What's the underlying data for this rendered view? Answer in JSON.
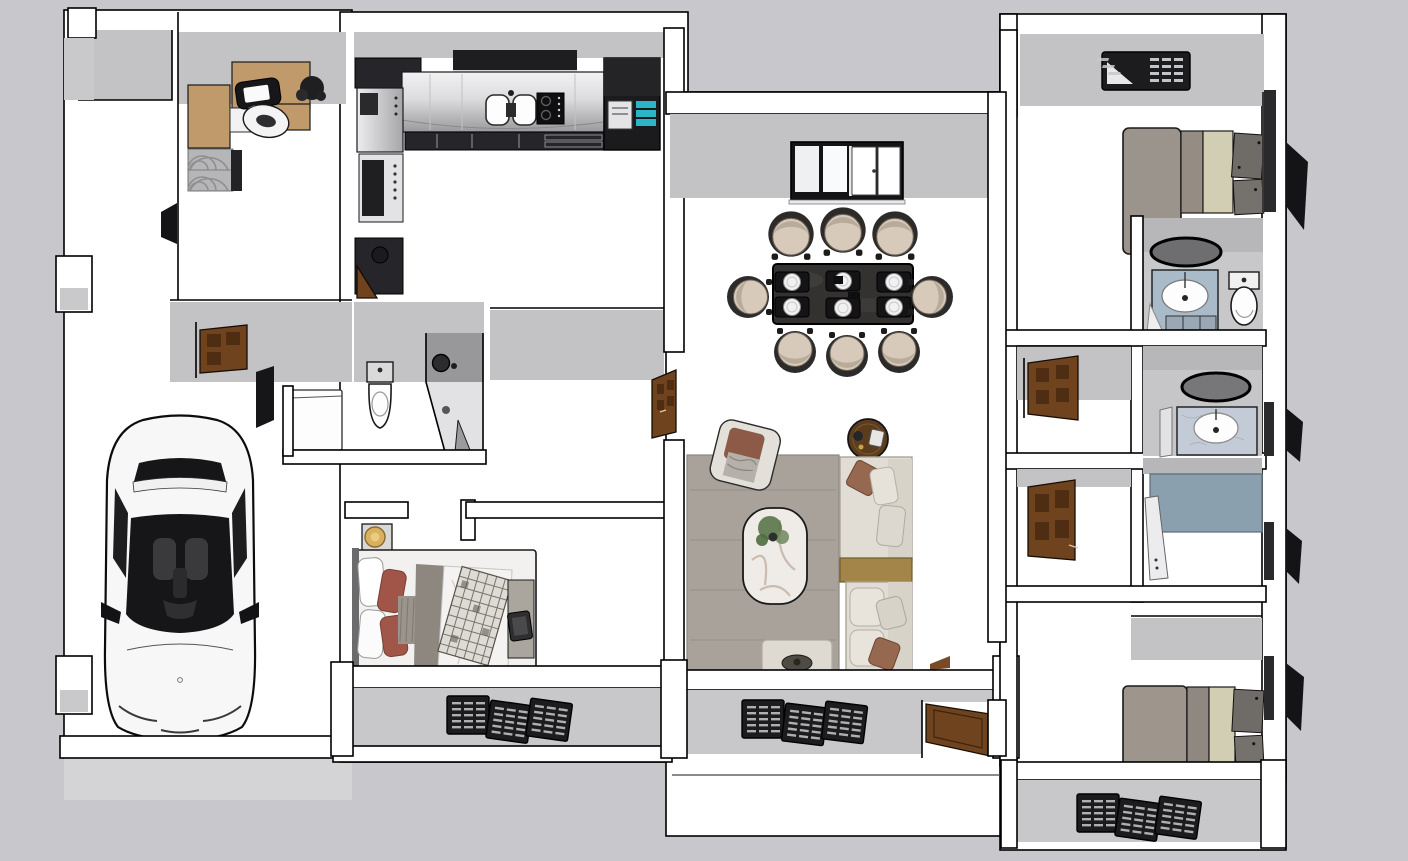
{
  "scene": {
    "title": "Top-down 3D render of a furnished apartment floor plan",
    "view": "orthographic top view, no visible text or UI chrome",
    "rooms": [
      {
        "name": "porch",
        "furniture": []
      },
      {
        "name": "home-office",
        "furniture": [
          "l-shaped-wood-desk",
          "laptop",
          "desk-chair",
          "plant",
          "patterned-rug",
          "bookshelf"
        ]
      },
      {
        "name": "hallway-left",
        "furniture": [
          "wood-door-open",
          "dark-wall-panel",
          "washing-machine"
        ]
      },
      {
        "name": "garage",
        "furniture": [
          "white-car-top-view"
        ]
      },
      {
        "name": "kitchen",
        "furniture": [
          "range-hood",
          "steel-counter",
          "double-sink",
          "cooktop",
          "base-cabinets",
          "refrigerator-teal-shelves",
          "wall-oven-column",
          "bar-stool",
          "service-door"
        ]
      },
      {
        "name": "bathroom-1",
        "furniture": [
          "toilet",
          "corner-shower"
        ]
      },
      {
        "name": "hall-center",
        "furniture": [
          "wood-door-open"
        ]
      },
      {
        "name": "bedroom-1",
        "furniture": [
          "bed-unmade",
          "plaid-throw",
          "red-pillows",
          "nightstand",
          "gold-lamp",
          "tablet",
          "foot-bench"
        ]
      },
      {
        "name": "dining-room",
        "furniture": [
          "sliding-window-4-pane",
          "dark-marble-table",
          "place-settings-x6",
          "dining-chairs-x8"
        ]
      },
      {
        "name": "living-room",
        "furniture": [
          "gray-area-rug",
          "marble-coffee-table",
          "potted-plant",
          "armchair",
          "round-side-table",
          "l-shaped-sofa",
          "gold-console",
          "ottoman-with-tray"
        ]
      },
      {
        "name": "bedroom-2",
        "furniture": [
          "ac-louver-unit",
          "platform-bed",
          "foot-benches"
        ]
      },
      {
        "name": "ensuite-bathroom",
        "furniture": [
          "oval-mirror",
          "blue-vanity-sink",
          "toilet"
        ]
      },
      {
        "name": "bathroom-2",
        "furniture": [
          "oval-mirror",
          "marble-vanity-sink",
          "glass-partition"
        ]
      },
      {
        "name": "shower-room",
        "furniture": [
          "blue-gray-wet-floor",
          "glass-panel"
        ]
      },
      {
        "name": "bedroom-3",
        "furniture": [
          "platform-bed",
          "foot-benches"
        ]
      },
      {
        "name": "terrace",
        "furniture": []
      }
    ],
    "exterior_features": [
      "louvered-shutter-triples-x3",
      "black-open-shutters-east-x4",
      "exterior-wood-door",
      "wall-pillars"
    ],
    "counts": {
      "dining_chairs": 8,
      "place_settings": 6,
      "shutter_panels_per_set": 3,
      "beds": 3,
      "bathrooms": 3,
      "wood_doors": 5
    }
  },
  "palette": {
    "background": "#c7c7cc",
    "floor": "#ffffff",
    "outline": "#000000",
    "wall-face-gray": "#c3c3c6",
    "band-gray": "#c8c8ca",
    "apron-gray": "#d4d4d7",
    "cabinet-dark": "#26262a",
    "steel-light": "#ececee",
    "steel-mid": "#a0a0a3",
    "wood-desk": "#c09a6a",
    "wood-door": "#70431f",
    "wood-door-dark": "#4e2d12",
    "rug-office": "#b6b6b8",
    "rug-arc": "#8f8f92",
    "dining-table": "#343230",
    "chair-beige": "#d7cabb",
    "chair-frame": "#2d2b29",
    "chair-shadow": "#b9ab99",
    "rug-living": "#a8a29a",
    "marble-white": "#efece7",
    "marble-vein": "#b9a193",
    "plant-green": "#5a7549",
    "sofa-cream": "#e1ddd4",
    "sofa-back": "#d7d3c9",
    "console-gold": "#a3854a",
    "side-table-wood": "#5b3d1d",
    "pillow-brown": "#96684f",
    "bed-gray": "#a79f95",
    "bed-gray-dark": "#8f8880",
    "bed-beige": "#d2ceb3",
    "bench-gray": "#6f6b66",
    "headboard-gray": "#9b948c",
    "blanket-red": "#a05548",
    "blanket-dark": "#8d877f",
    "duvet-white": "#f4f3f1",
    "knit-gray": "#9a948c",
    "lamp-gold": "#d9b05e",
    "vanity-blue": "#a9bac9",
    "vanity-marble": "#c2cbd6",
    "mirror-dark": "#6e6e71",
    "shower-blue": "#8ba0af",
    "shower-tile": "#98989b",
    "vent-dark": "#1c1c1f",
    "louver-light": "#c9c9c9",
    "fridge-teal": "#2ab5c8",
    "car-white": "#f7f7f7",
    "car-glass": "#161618",
    "seat-dark": "#3a3a3d",
    "toilet-white": "#fdfdfd"
  }
}
